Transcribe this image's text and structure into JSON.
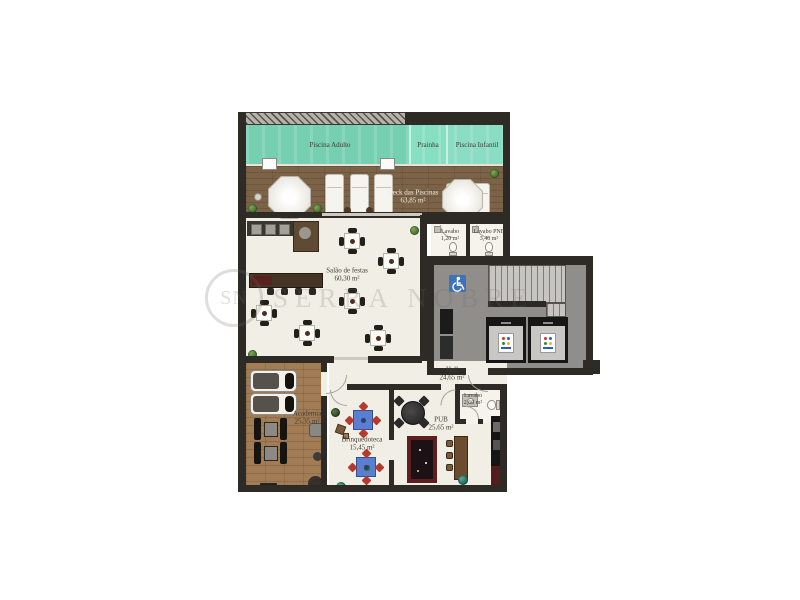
{
  "watermark": {
    "logo_text": "SN",
    "brand_text": "SERRA NOBRE"
  },
  "rooms": {
    "piscina_adulto": {
      "name": "Piscina Adulto"
    },
    "prainha": {
      "name": "Prainha"
    },
    "piscina_infantil": {
      "name": "Piscina Infantil"
    },
    "deck": {
      "name": "Deck das Piscinas",
      "area": "63,85 m²"
    },
    "salao_de_festas": {
      "name": "Salão de festas",
      "area": "60,30 m²"
    },
    "lavabo_1": {
      "name": "Lavabo",
      "area": "1,20 m²"
    },
    "lavabo_pne": {
      "name": "Lavabo PNE",
      "area": "3,40 m²"
    },
    "hall": {
      "name": "Hall",
      "area": "24,65 m²"
    },
    "academia": {
      "name": "Academia",
      "area": "25,35 m²"
    },
    "brinquedoteca": {
      "name": "Brinquedoteca",
      "area": "15,45 m²"
    },
    "pub": {
      "name": "PUB",
      "area": "25,65 m²"
    },
    "lavabo_2": {
      "name": "Lavabo",
      "area": "2,60 m²"
    }
  },
  "colors": {
    "wall": "#2e2b27",
    "floor": "#f1eee6",
    "pool-a": "#75cfb1",
    "pool-b": "#86dfc1",
    "pool-c": "#8adcc2",
    "deck": "#7c6347",
    "gym": "#a27c54",
    "accent": "#3f72b8",
    "kidblue": "#5b7fd0",
    "kidred": "#b6392e",
    "pooltbl": "#5e1f1f",
    "elevblue": "#2b5bc4"
  }
}
